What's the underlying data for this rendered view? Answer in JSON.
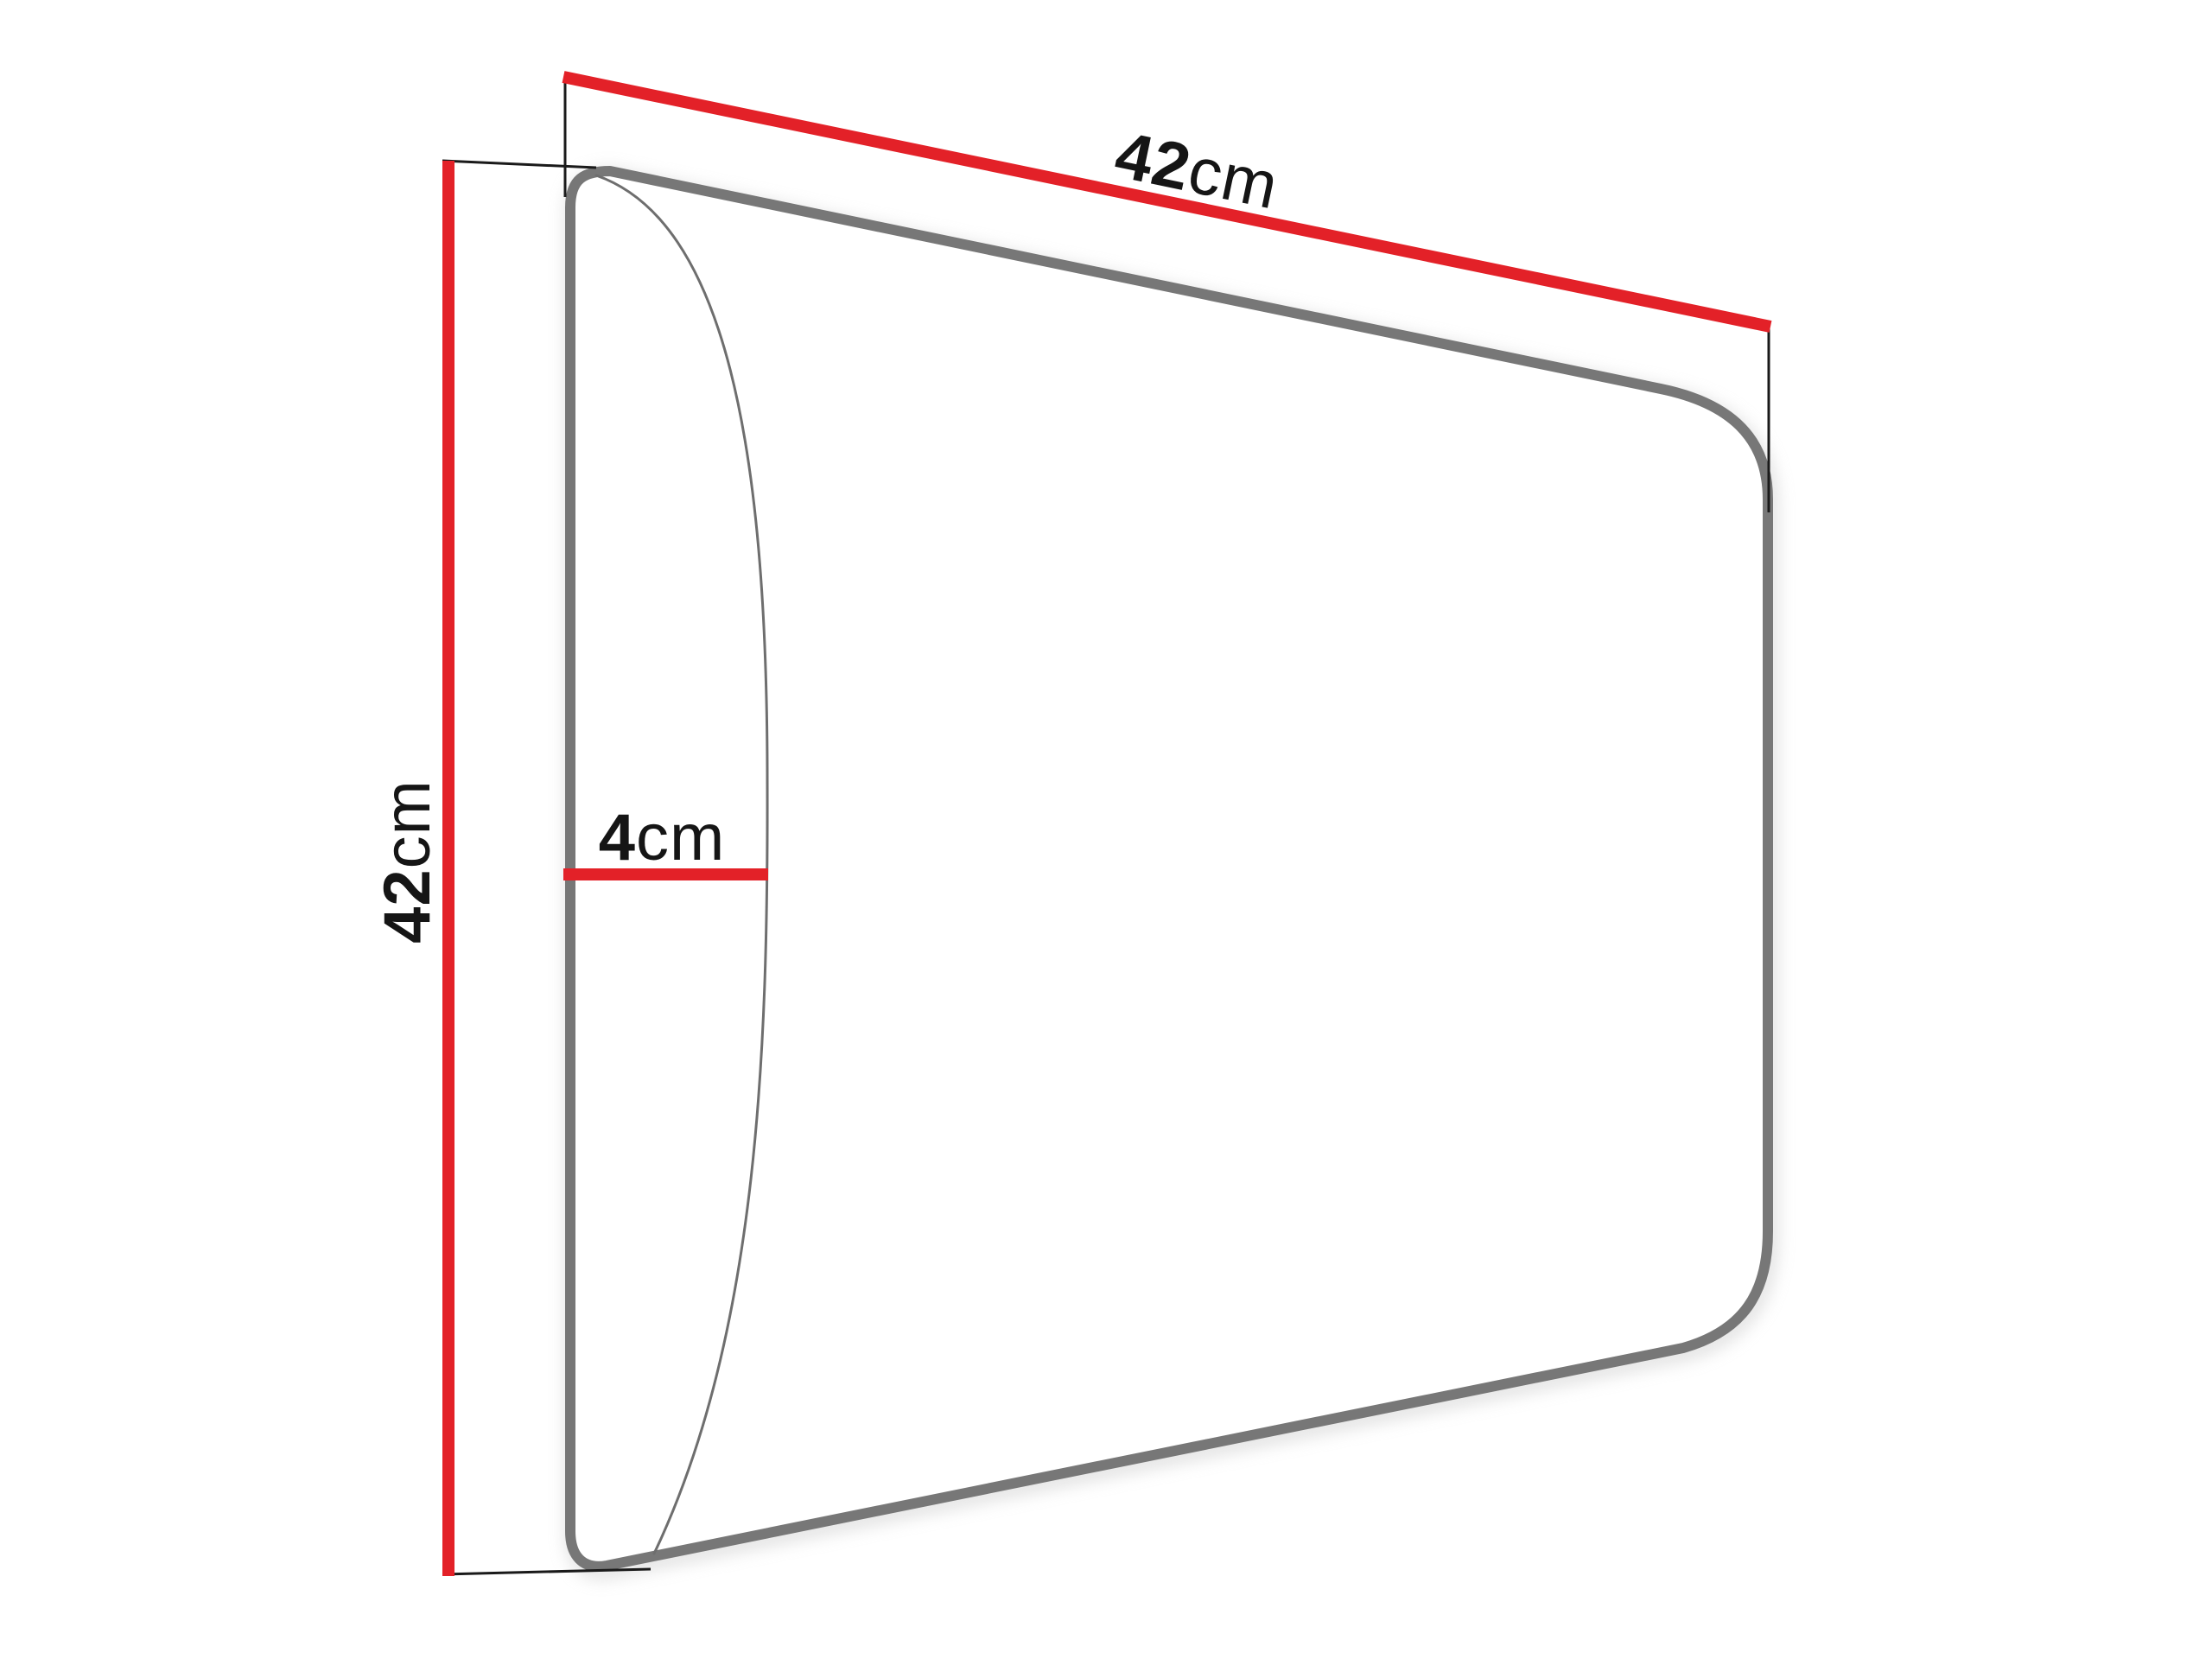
{
  "diagram": {
    "kind": "panel-dimension-diagram",
    "dimensions": {
      "width": {
        "value": "42",
        "unit": "cm"
      },
      "height": {
        "value": "42",
        "unit": "cm"
      },
      "depth": {
        "value": "4",
        "unit": "cm"
      }
    },
    "colors": {
      "dimension-line": "#e32128",
      "panel-outline": "#777777",
      "panel-curve": "#6e6e6e",
      "extension-line": "#1a1a1a",
      "background": "#ffffff",
      "shadow": "#c9c9c9"
    }
  }
}
